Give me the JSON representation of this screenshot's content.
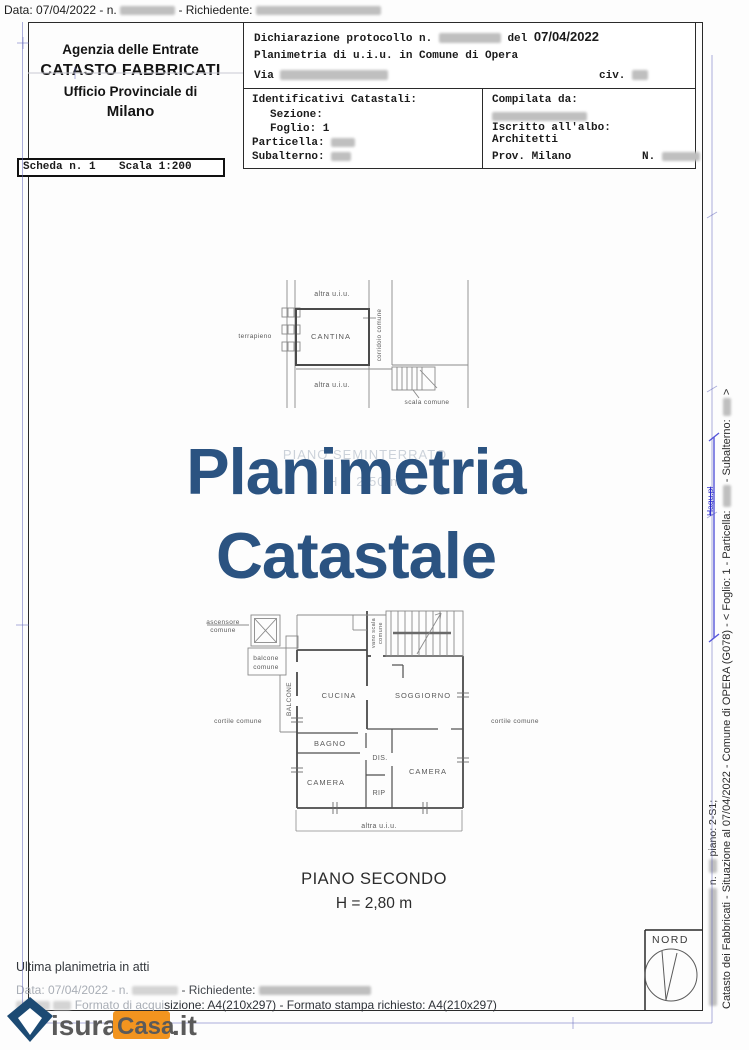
{
  "top_bar": {
    "label": "Data: 07/04/2022 - n.",
    "richiedente": "- Richiedente:"
  },
  "agency": {
    "line1": "Agenzia delle Entrate",
    "line2": "CATASTO FABBRICATI",
    "line3": "Ufficio Provinciale di",
    "line4": "Milano"
  },
  "declaration": {
    "protocol_prefix": "Dichiarazione protocollo n.",
    "protocol_del": "del",
    "protocol_date": "07/04/2022",
    "line2": "Planimetria di u.i.u. in Comune di Opera",
    "via": "Via",
    "civ": "civ."
  },
  "identifiers": {
    "title": "Identificativi Catastali:",
    "sezione": "Sezione:",
    "foglio": "Foglio: 1",
    "particella": "Particella:",
    "subalterno": "Subalterno:"
  },
  "compiler": {
    "title": "Compilata da:",
    "albo1": "Iscritto all'albo:",
    "albo2": "Architetti",
    "prov": "Prov. Milano",
    "n_label": "N."
  },
  "scheda": {
    "number": "Scheda n. 1",
    "scale": "Scala 1:200"
  },
  "watermark": {
    "line1": "Planimetria",
    "line2": "Catastale"
  },
  "ghost": {
    "line1": "PIANO SEMINTERRATO",
    "line2": "H = 2,50 m"
  },
  "cantina_plan": {
    "terrapieno": "terrapieno",
    "altra_top": "altra u.i.u.",
    "room": "CANTINA",
    "corridoio": "corridoio comune",
    "altra_bottom": "altra u.i.u.",
    "scala": "scala comune"
  },
  "main_plan": {
    "ascensore1": "ascensore",
    "ascensore2": "comune",
    "balcone1": "balcone",
    "balcone2": "comune",
    "balcone_strip": "BALCONE",
    "cucina": "CUCINA",
    "vano1": "vano scala",
    "vano2": "comune",
    "soggiorno": "SOGGIORNO",
    "cortile_left": "cortile comune",
    "cortile_right": "cortile comune",
    "bagno": "BAGNO",
    "dis": "DIS.",
    "camera1": "CAMERA",
    "rip": "RIP",
    "camera2": "CAMERA",
    "altra": "altra u.i.u."
  },
  "caption": {
    "line1": "PIANO SECONDO",
    "line2": "H = 2,80 m"
  },
  "side_text": {
    "part1": "Catasto dei Fabbricati - Situazione al 07/04/2022 - Comune di OPERA (G078) -  <  Foglio: 1 - Particella:",
    "part2": "- Subalterno:",
    "part3": ">",
    "n_label": "n.",
    "piano": "piano: 2-S1;",
    "blue_note": "Hagu.pl"
  },
  "footer": {
    "ultima": "Ultima planimetria in atti",
    "data_prefix": "Data: 07/04/2022 - n.",
    "data_mid": "- Richiedente:",
    "formato_faint": "Formato di acqui",
    "formato_clear": "sizione: A4(210x297)  - Formato stampa richiesto: A4(210x297)"
  },
  "logo": {
    "isura": "isura",
    "casa": "Casa",
    "it": ".it"
  },
  "nord": "NORD",
  "colors": {
    "watermark": "#2b5381",
    "logo_blue": "#1c4a73",
    "logo_orange": "#f2941f",
    "pen_blue": "#3b3bd4"
  }
}
